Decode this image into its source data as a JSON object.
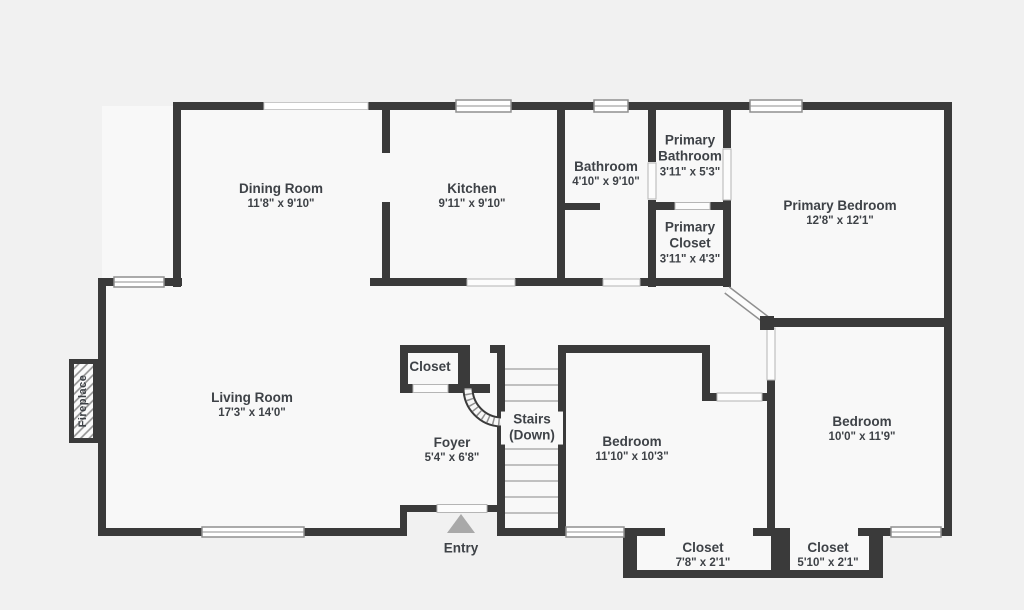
{
  "floor_plan": {
    "rooms": [
      {
        "id": "dining-room",
        "name": "Dining Room",
        "dims": "11'8\" x 9'10\""
      },
      {
        "id": "kitchen",
        "name": "Kitchen",
        "dims": "9'11\" x 9'10\""
      },
      {
        "id": "bathroom",
        "name": "Bathroom",
        "dims": "4'10\" x 9'10\""
      },
      {
        "id": "primary-bathroom",
        "name": "Primary Bathroom",
        "dims": "3'11\" x 5'3\""
      },
      {
        "id": "primary-closet",
        "name": "Primary Closet",
        "dims": "3'11\" x 4'3\""
      },
      {
        "id": "primary-bedroom",
        "name": "Primary Bedroom",
        "dims": "12'8\" x 12'1\""
      },
      {
        "id": "living-room",
        "name": "Living Room",
        "dims": "17'3\" x 14'0\""
      },
      {
        "id": "foyer-closet",
        "name": "Closet",
        "dims": ""
      },
      {
        "id": "foyer",
        "name": "Foyer",
        "dims": "5'4\" x 6'8\""
      },
      {
        "id": "stairs",
        "name": "Stairs (Down)",
        "dims": ""
      },
      {
        "id": "bedroom-left",
        "name": "Bedroom",
        "dims": "11'10\" x 10'3\""
      },
      {
        "id": "bedroom-right",
        "name": "Bedroom",
        "dims": "10'0\" x 11'9\""
      },
      {
        "id": "closet-left",
        "name": "Closet",
        "dims": "7'8\" x 2'1\""
      },
      {
        "id": "closet-right",
        "name": "Closet",
        "dims": "5'10\" x 2'1\""
      }
    ],
    "annotations": {
      "entry": "Entry",
      "fireplace": "Fireplace"
    },
    "colors": {
      "wall": "#3a3a3a",
      "floor": "#f8f8f8",
      "background": "#f1f1f1",
      "text": "#3e4247",
      "window_frame": "#8f8f8f",
      "entry_arrow": "#a9a9a9"
    }
  }
}
